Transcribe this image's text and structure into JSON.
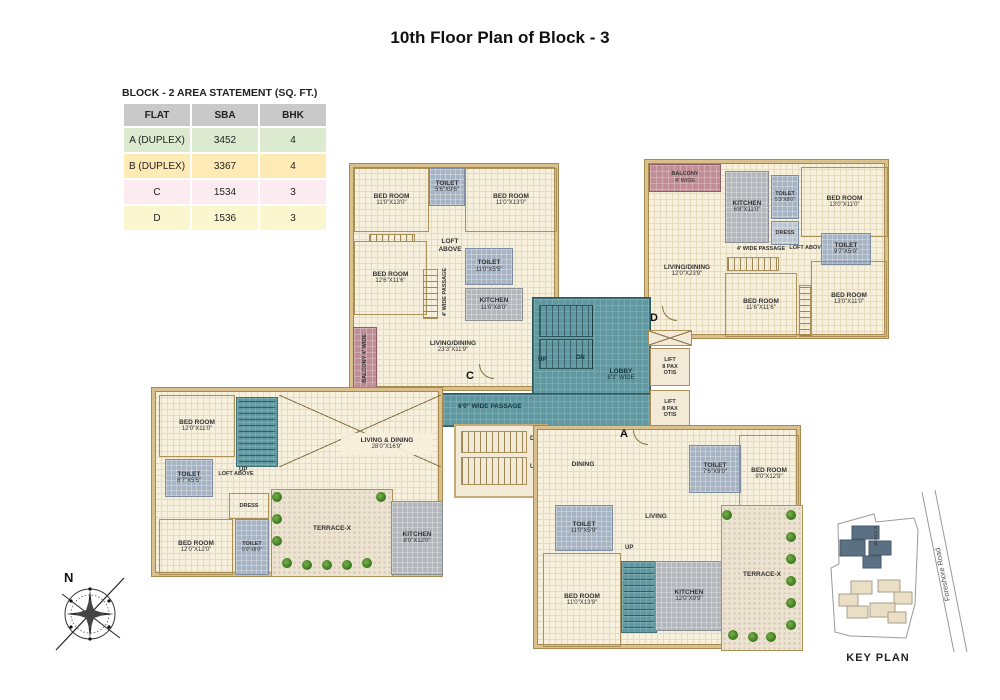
{
  "title": "10th Floor Plan of Block - 3",
  "table": {
    "heading": "BLOCK - 2 AREA STATEMENT (SQ. FT.)",
    "columns": [
      "FLAT",
      "SBA",
      "BHK"
    ],
    "rows": [
      [
        "A (DUPLEX)",
        "3452",
        "4"
      ],
      [
        "B (DUPLEX)",
        "3367",
        "4"
      ],
      [
        "C",
        "1534",
        "3"
      ],
      [
        "D",
        "1536",
        "3"
      ]
    ]
  },
  "rooms": {
    "c_bed1": {
      "name": "BED ROOM",
      "dims": "11'0\"X13'0\""
    },
    "c_toilet1": {
      "name": "TOILET",
      "dims": "5'6\"X9'6\""
    },
    "c_bed2": {
      "name": "BED ROOM",
      "dims": "11'0\"X13'0\""
    },
    "c_bed3": {
      "name": "BED ROOM",
      "dims": "12'6\"X11'6\""
    },
    "c_toilet2": {
      "name": "TOILET",
      "dims": "11'0\"X5'5\""
    },
    "c_kitchen": {
      "name": "KITCHEN",
      "dims": "11'0\"X8'0\""
    },
    "c_loft": {
      "name": "LOFT ABOVE"
    },
    "c_passage": {
      "name": "4' WIDE PASSAGE"
    },
    "c_balcony": {
      "name": "BALCONY 4' WIDE"
    },
    "c_living": {
      "name": "LIVING/DINING",
      "dims": "23'3\"X11'9\""
    },
    "d_balcony": {
      "name": "BALCONY",
      "dims": "4' WIDE"
    },
    "d_kitchen": {
      "name": "KITCHEN",
      "dims": "6'8\"X11'0\""
    },
    "d_toilet1": {
      "name": "TOILET",
      "dims": "5'3\"X8'0\""
    },
    "d_dress": {
      "name": "DRESS"
    },
    "d_bed1": {
      "name": "BED ROOM",
      "dims": "13'0\"X11'0\""
    },
    "d_passage": {
      "name": "4' WIDE PASSAGE"
    },
    "d_loft": {
      "name": "LOFT ABOVE"
    },
    "d_toilet2": {
      "name": "TOILET",
      "dims": "9'7\"X5'0\""
    },
    "d_living": {
      "name": "LIVING/DINING",
      "dims": "12'0\"X23'9\""
    },
    "d_bed2": {
      "name": "BED ROOM",
      "dims": "11'6\"X11'6\""
    },
    "d_bed3": {
      "name": "BED ROOM",
      "dims": "13'0\"X11'0\""
    },
    "core_lobby": {
      "name": "LOBBY",
      "dims": "8'3\" WIDE"
    },
    "core_passage": {
      "name": "6'0\" WIDE PASSAGE"
    },
    "lift": {
      "l1": "LIFT",
      "l2": "8 PAX",
      "l3": "OTIS"
    },
    "b_bed1": {
      "name": "BED ROOM",
      "dims": "12'0\"X11'0\""
    },
    "b_toilet1": {
      "name": "TOILET",
      "dims": "8'7\"X5'5\""
    },
    "b_loft": {
      "name": "LOFT ABOVE"
    },
    "b_living": {
      "name": "LIVING & DINING",
      "dims": "28'0\"X16'9\""
    },
    "b_dress": {
      "name": "DRESS"
    },
    "b_bed2": {
      "name": "BED ROOM",
      "dims": "12'0\"X12'0\""
    },
    "b_toilet2": {
      "name": "TOILET",
      "dims": "5'0\"X8'0\""
    },
    "b_terrace": {
      "name": "TERRACE-X"
    },
    "b_kitchen": {
      "name": "KITCHEN",
      "dims": "8'0\"X12'0\""
    },
    "a_dining": {
      "name": "DINING"
    },
    "a_toilet1": {
      "name": "TOILET",
      "dims": "7'6\"X9'0\""
    },
    "a_bed1": {
      "name": "BED ROOM",
      "dims": "9'0\"X12'9\""
    },
    "a_toilet2": {
      "name": "TOILET",
      "dims": "11'0\"X5'9\""
    },
    "a_living": {
      "name": "LIVING"
    },
    "a_bed2": {
      "name": "BED ROOM",
      "dims": "11'0\"X13'9\""
    },
    "a_kitchen": {
      "name": "KITCHEN",
      "dims": "12'0\"X9'9\""
    },
    "a_terrace": {
      "name": "TERRACE-X"
    }
  },
  "labels": {
    "up": "UP",
    "dn": "DN",
    "door_a": "A",
    "door_b": "B",
    "door_c": "C",
    "door_d": "D"
  },
  "compass": {
    "north": "N"
  },
  "keyplan": {
    "title": "KEY PLAN",
    "road": "Foreshore Road",
    "block": "BLOCK 3"
  },
  "colors": {
    "floor": "#f7f0dd",
    "wall": "#d9c08c",
    "teal": "#5f98a0",
    "wet": "#a6b3c2",
    "kitchen": "#b3b7bb",
    "balcony": "#c08d96",
    "terrace": "#ece3d2",
    "plant": "#3f7d22",
    "table_header": "#c9c9c9",
    "row_a": "#dcead0",
    "row_b": "#fdeab5",
    "row_c": "#fcebf1",
    "row_d": "#fcf6cf"
  }
}
